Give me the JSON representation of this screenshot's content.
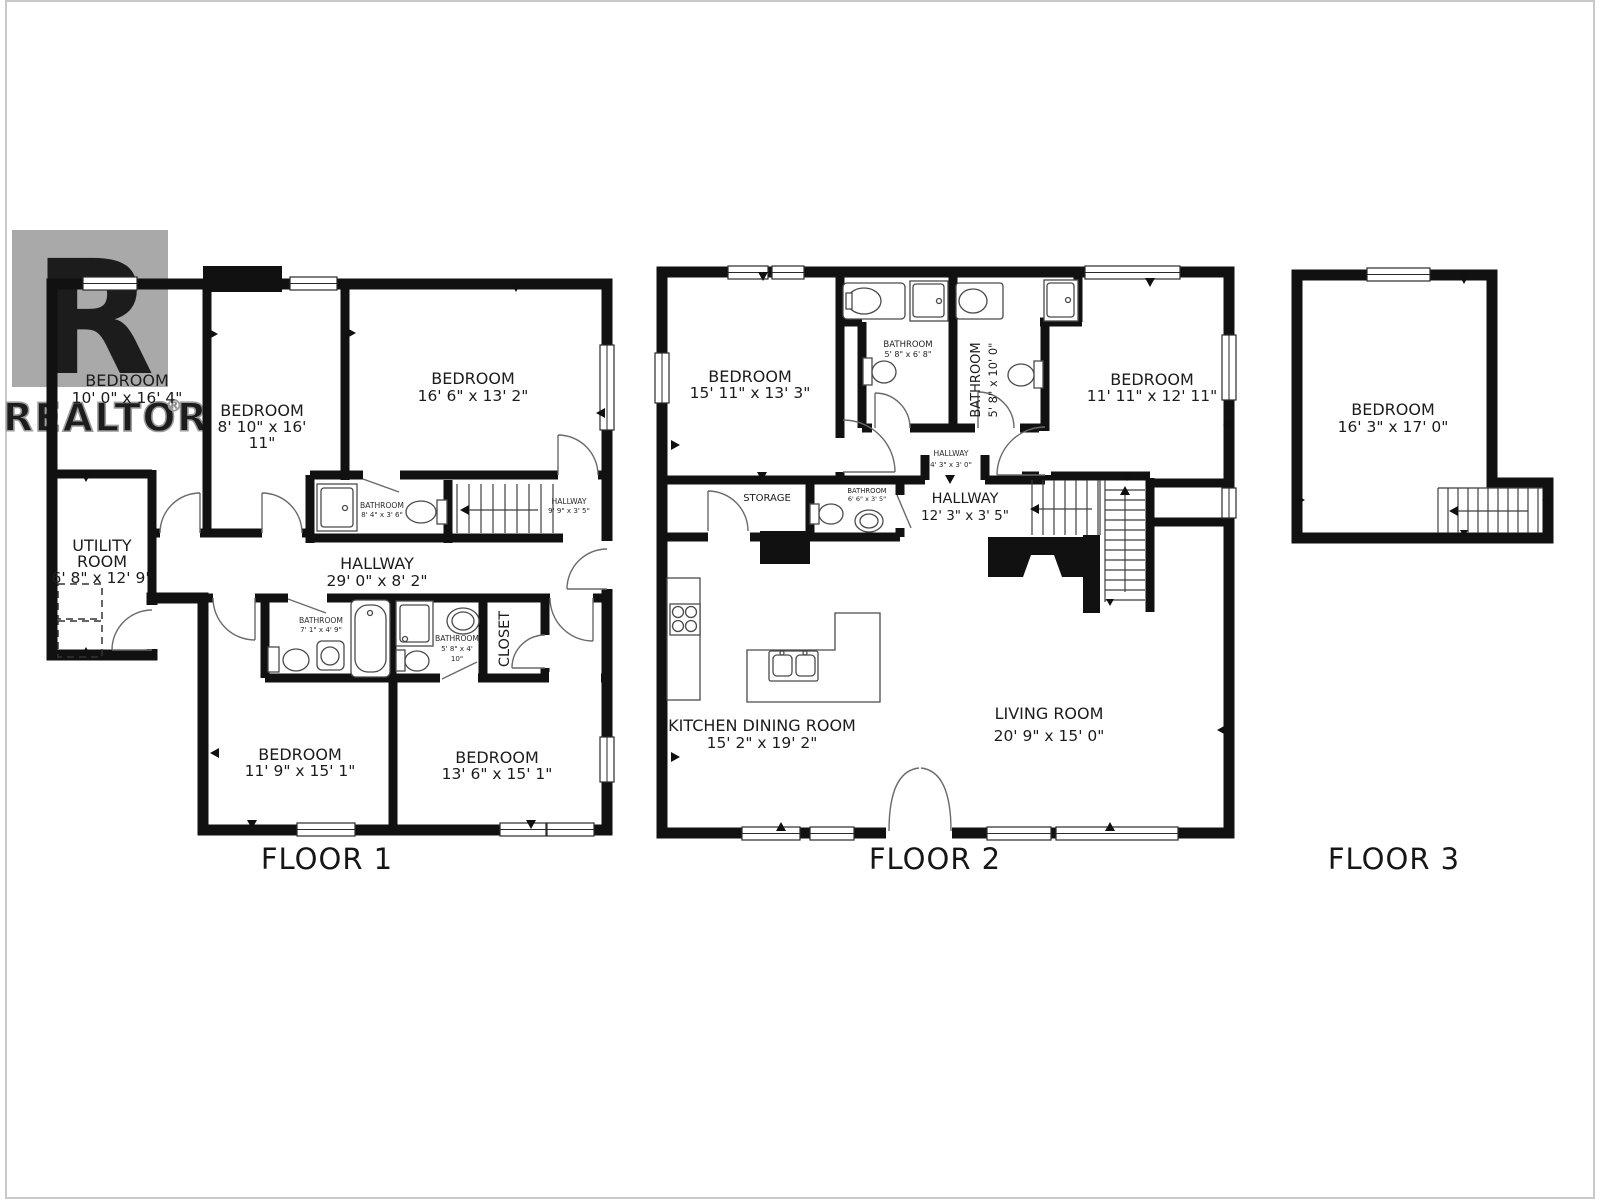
{
  "page": {
    "background": "#ffffff",
    "frame_color": "#c9c9c9",
    "wall_color": "#111111"
  },
  "watermark": {
    "logo_letter": "R",
    "brand": "REALTOR",
    "registered": "®",
    "logo_color": "#a9a9a9"
  },
  "floor1": {
    "caption": "FLOOR 1",
    "bedroom_tl": {
      "name": "BEDROOM",
      "dims": "10' 0\" x 16' 4\""
    },
    "bedroom_tm": {
      "name": "BEDROOM",
      "dims_line1": "8' 10\" x 16'",
      "dims_line2": "11\""
    },
    "bedroom_tr": {
      "name": "BEDROOM",
      "dims": "16' 6\" x 13' 2\""
    },
    "utility": {
      "name_line1": "UTILITY",
      "name_line2": "ROOM",
      "dims": "6' 8\" x 12' 9\""
    },
    "bathroom_mid": {
      "name": "BATHROOM",
      "dims": "8' 4\" x 3' 6\""
    },
    "hallway_stairs": {
      "name": "HALLWAY",
      "dims": "9' 9\" x 3' 5\""
    },
    "hallway_main": {
      "name": "HALLWAY",
      "dims": "29' 0\" x 8' 2\""
    },
    "bathroom_left": {
      "name": "BATHROOM",
      "dims": "7' 1\" x 4' 9\""
    },
    "bathroom_right": {
      "name": "BATHROOM",
      "dims_line1": "5' 8\" x 4'",
      "dims_line2": "10\""
    },
    "closet": {
      "name": "CLOSET"
    },
    "bedroom_bl": {
      "name": "BEDROOM",
      "dims": "11' 9\" x 15' 1\""
    },
    "bedroom_br": {
      "name": "BEDROOM",
      "dims": "13' 6\" x 15' 1\""
    }
  },
  "floor2": {
    "caption": "FLOOR 2",
    "bedroom_tl": {
      "name": "BEDROOM",
      "dims": "15' 11\" x 13' 3\""
    },
    "bathroom_tm": {
      "name": "BATHROOM",
      "dims": "5' 8\" x 6' 8\""
    },
    "bathroom_tv": {
      "name": "BATHROOM",
      "dims": "5' 8\" x 10' 0\""
    },
    "bedroom_tr": {
      "name": "BEDROOM",
      "dims": "11' 11\" x 12' 11\""
    },
    "hallway_small": {
      "name": "HALLWAY",
      "dims": "4' 3\" x 3' 0\""
    },
    "storage": {
      "name": "STORAGE"
    },
    "bathroom_ms": {
      "name": "BATHROOM",
      "dims": "6' 6\" x 3' 5\""
    },
    "hallway_mid": {
      "name": "HALLWAY",
      "dims": "12' 3\" x 3' 5\""
    },
    "kitchen": {
      "name": "KITCHEN DINING ROOM",
      "dims": "15' 2\" x 19' 2\""
    },
    "living": {
      "name": "LIVING ROOM",
      "dims": "20' 9\" x 15' 0\""
    }
  },
  "floor3": {
    "caption": "FLOOR 3",
    "bedroom": {
      "name": "BEDROOM",
      "dims": "16' 3\" x 17' 0\""
    }
  }
}
